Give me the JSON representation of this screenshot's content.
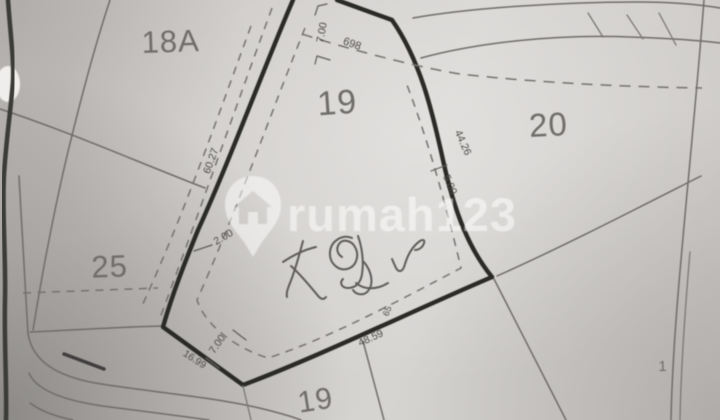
{
  "watermark": {
    "brand": "rumah123",
    "icon": "house-pin-icon"
  },
  "parcels": {
    "p18a": "18A",
    "p19_top": "19",
    "p20": "20",
    "p25": "25",
    "p19_bottom": "19",
    "p1_partial": "1"
  },
  "dims": {
    "top_setback": "7.00",
    "parcel_no": "698",
    "left_side": "60.27",
    "left_setback": "2.00",
    "right_side": "44.26",
    "right_setback": "5.00",
    "bottom_side": "48.59",
    "bottom_mark": "65",
    "corner_width": "7.00",
    "corner_side": "16.99"
  },
  "colors": {
    "paper": "#cfcdca",
    "boundary_bold": "#2a2927",
    "line_thin": "#6f6c69",
    "dashed": "#75726f",
    "parcel_label": "#6f6d6a",
    "dimension_text": "#4e4c4a",
    "watermark_white": "rgba(255,255,255,0.52)",
    "signature_ink": "#4e4c4a"
  }
}
